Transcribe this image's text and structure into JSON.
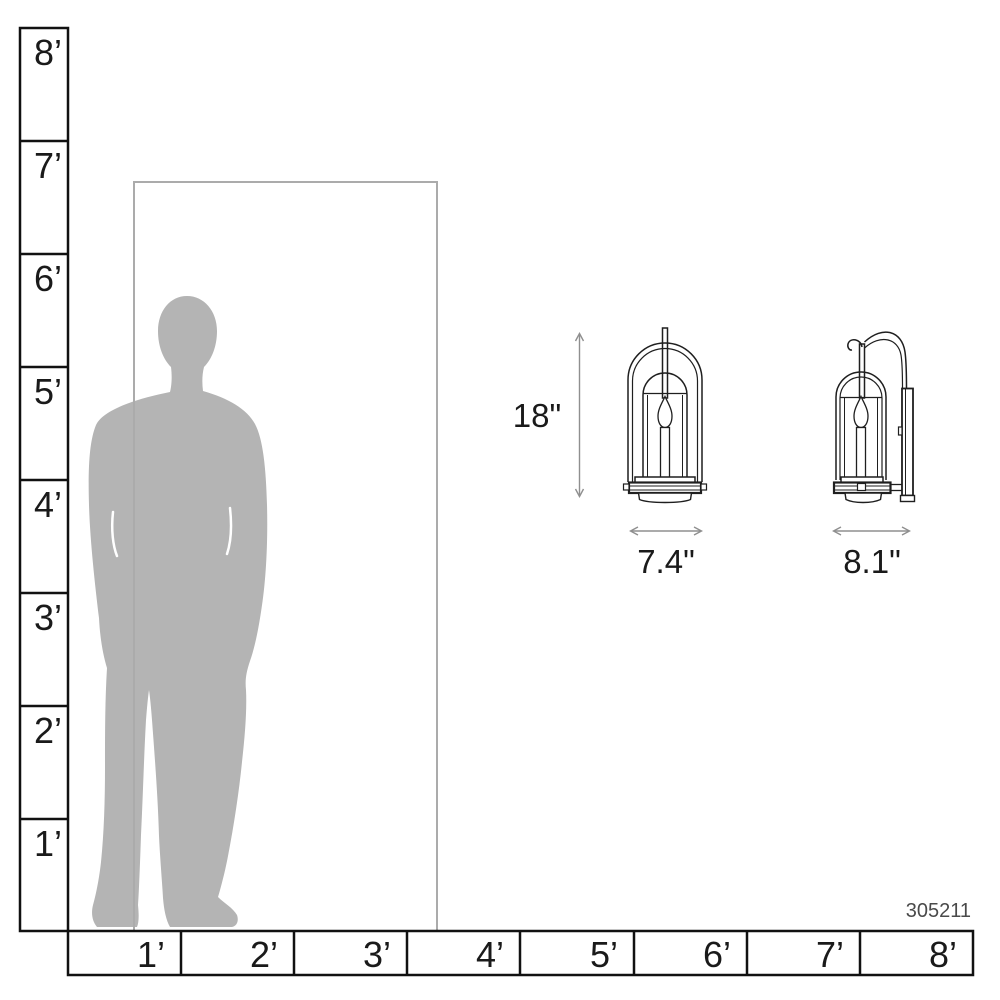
{
  "diagram": {
    "title": "product-scale-dimension-diagram",
    "product_number": "305211",
    "dimensions": {
      "height_label": "18\"",
      "width_label": "7.4\"",
      "depth_label": "8.1\""
    },
    "vertical_ruler": {
      "labels": [
        "8’",
        "7’",
        "6’",
        "5’",
        "4’",
        "3’",
        "2’",
        "1’"
      ]
    },
    "horizontal_ruler": {
      "labels": [
        "1’",
        "2’",
        "3’",
        "4’",
        "5’",
        "6’",
        "7’",
        "8’"
      ]
    },
    "colors": {
      "silhouette": "#b4b4b4",
      "door_outline": "#ababab",
      "ruler_line": "#111111",
      "drawing_line": "#1f1f1f",
      "dimension_arrow": "#8f8f8f",
      "product_number_text": "#4a4a4a",
      "background": "#ffffff"
    }
  }
}
